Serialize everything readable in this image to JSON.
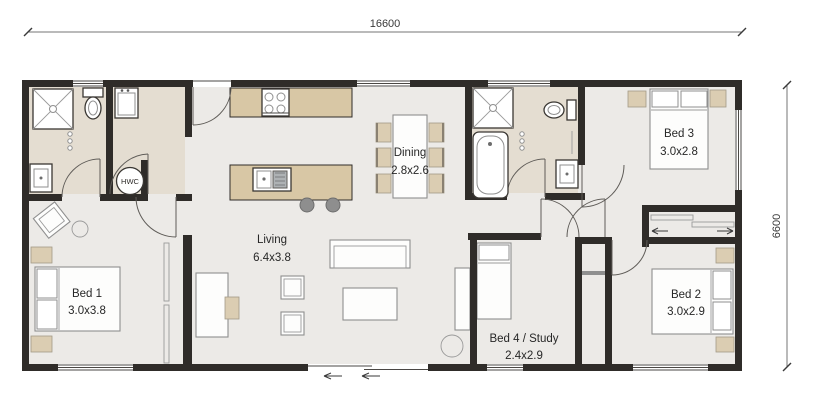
{
  "plan": {
    "dimension_top": "16600",
    "dimension_right": "6600",
    "rooms": [
      {
        "name": "Living",
        "size": "6.4x3.8"
      },
      {
        "name": "Dining",
        "size": "2.8x2.6"
      },
      {
        "name": "Bed 1",
        "size": "3.0x3.8"
      },
      {
        "name": "Bed 2",
        "size": "3.0x2.9"
      },
      {
        "name": "Bed 3",
        "size": "3.0x2.8"
      },
      {
        "name": "Bed 4 / Study",
        "size": "2.4x2.9"
      }
    ],
    "labels": {
      "hot_water_cylinder": "HWC"
    },
    "colors": {
      "wall": "#2f2c29",
      "floor": "#eceae7",
      "wet_floor": "#e4ddd1",
      "cabinet": "#d8c7a5",
      "furniture_fill": "#fdfdfc",
      "furniture_stroke": "#8f8f8f",
      "stool": "#8e8e8e",
      "dimension_line": "#757575",
      "label_text": "#272727"
    }
  }
}
